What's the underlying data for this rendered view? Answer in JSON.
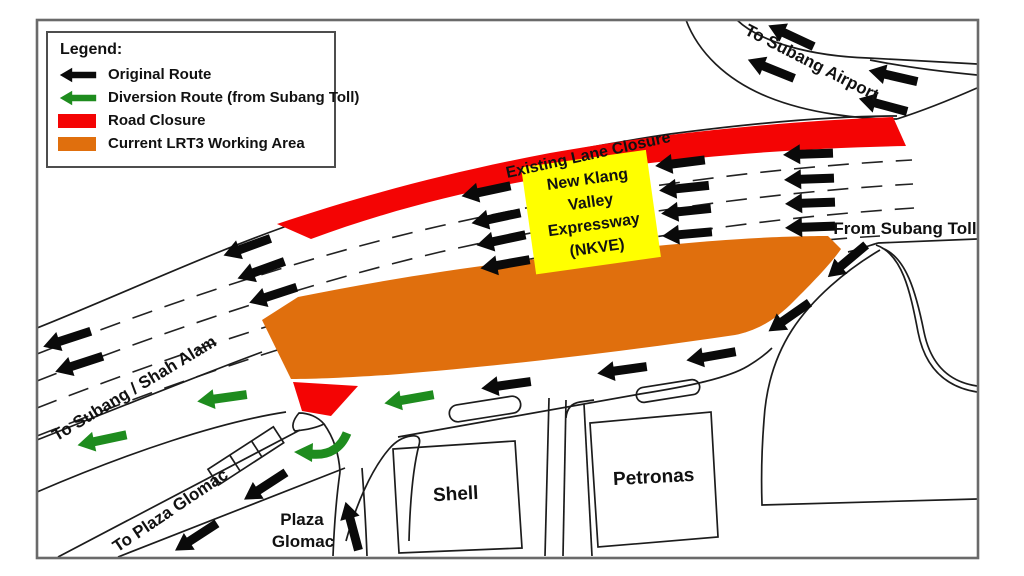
{
  "colors": {
    "original_route": "#0a0a0a",
    "diversion_route": "#1e8c1e",
    "road_closure": "#f40404",
    "working_area": "#e06f0d",
    "nkve_bg": "#ffff00"
  },
  "legend": {
    "title": "Legend:",
    "items": [
      {
        "label": "Original Route",
        "icon": "black-arrow"
      },
      {
        "label": "Diversion Route (from Subang Toll)",
        "icon": "green-arrow"
      },
      {
        "label": "Road Closure",
        "icon": "red-swatch"
      },
      {
        "label": "Current LRT3 Working Area",
        "icon": "orange-swatch"
      }
    ]
  },
  "labels": {
    "to_subang_airport": "To Subang Airport",
    "existing_lane_closure": "Existing Lane Closure",
    "from_subang_toll": "From Subang Toll",
    "to_subang_shah_alam": "To Subang / Shah Alam",
    "to_plaza_glomac": "To Plaza Glomac",
    "plaza_glomac_line1": "Plaza",
    "plaza_glomac_line2": "Glomac",
    "shell": "Shell",
    "petronas": "Petronas"
  },
  "nkve_box": {
    "line1": "New Klang",
    "line2": "Valley",
    "line3": "Expressway",
    "line4": "(NKVE)"
  }
}
